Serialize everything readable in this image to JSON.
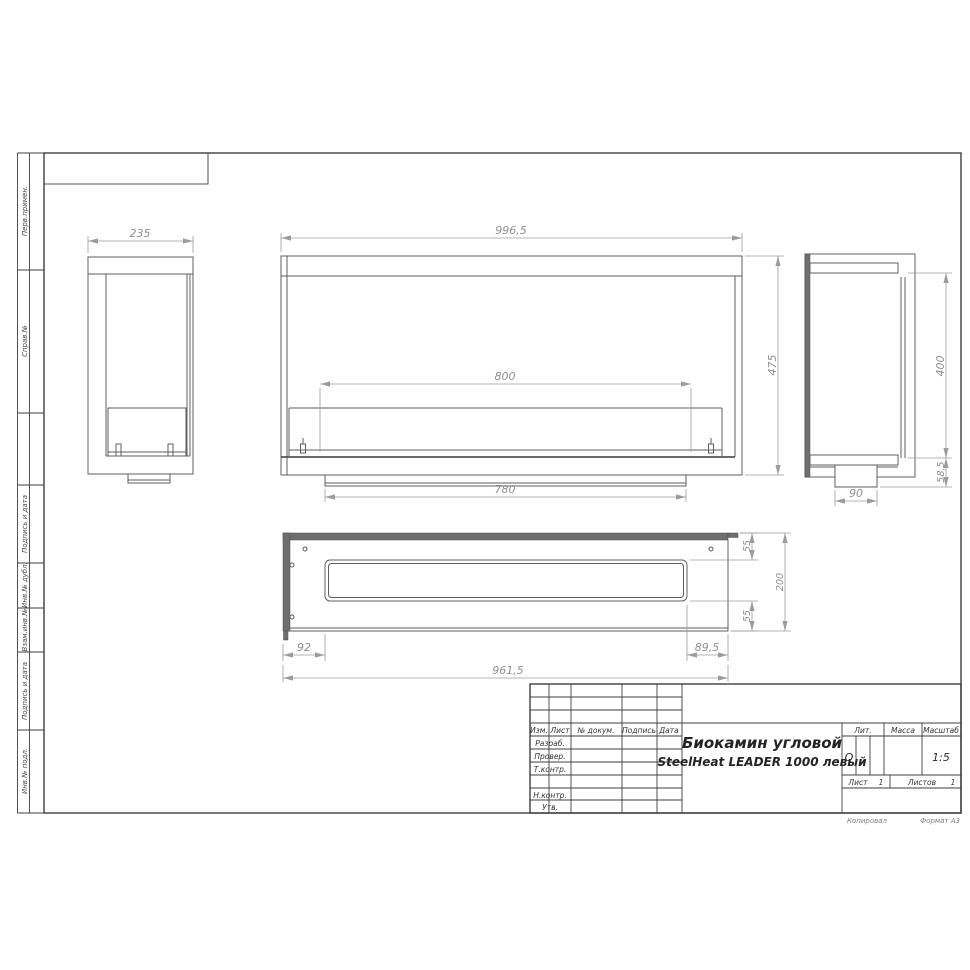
{
  "margin_labels": [
    "Перв.примен.",
    "Справ.№",
    "Подпись и дата",
    "Инв.№ дубл.",
    "Взам.инв.№",
    "Подпись и дата",
    "Инв.№ подл."
  ],
  "title_block": {
    "change_header": {
      "izm": "Изм.",
      "list": "Лист",
      "doc": "№ докум.",
      "sign": "Подпись",
      "date": "Дата"
    },
    "roles": [
      "Разраб.",
      "Провер.",
      "Т.контр.",
      "Н.контр.",
      "Утв."
    ],
    "title_line1": "Биокамин угловой",
    "title_line2": "SteelHeat LEADER 1000 левый",
    "lit_label": "Лит.",
    "lit_value": "О",
    "mass_label": "Масса",
    "scale_label": "Масштаб",
    "scale_value": "1:5",
    "sheet_label": "Лист",
    "sheet_number": "1",
    "sheets_label": "Листов",
    "sheets_total": "1"
  },
  "footer": {
    "copied": "Копировал",
    "format": "Формат А3"
  },
  "views": {
    "side_left": {
      "width": "235"
    },
    "front": {
      "width": "996,5",
      "burner_length": "800",
      "base_width": "780",
      "height": "475"
    },
    "side_right": {
      "height": "400",
      "bottom_offset": "58,5",
      "tray_width": "90"
    },
    "plan": {
      "left_offset": "92",
      "total_length": "961,5",
      "right_offset": "89,5",
      "top_margin": "55",
      "depth": "200",
      "bottom_margin": "55"
    }
  }
}
